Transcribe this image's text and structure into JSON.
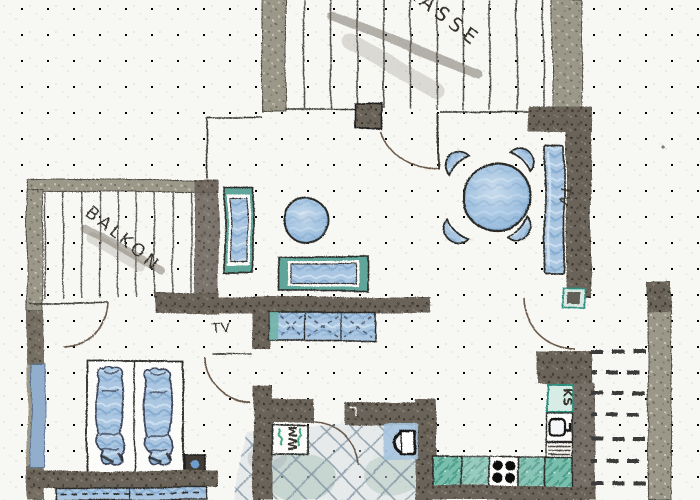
{
  "labels": {
    "terrace": "TERRASSE",
    "balcony": "BALKON",
    "tv_living": "TV",
    "tv_hall": "TV",
    "washer": "WM",
    "fridge": "KS"
  },
  "colors": {
    "paper": "#f7f7f4",
    "wall_dark": "#6b635a",
    "wall_light": "#9b988a",
    "furniture_blue": "#aac6e0",
    "accent_teal": "#7abfae",
    "ink": "#34302b"
  }
}
